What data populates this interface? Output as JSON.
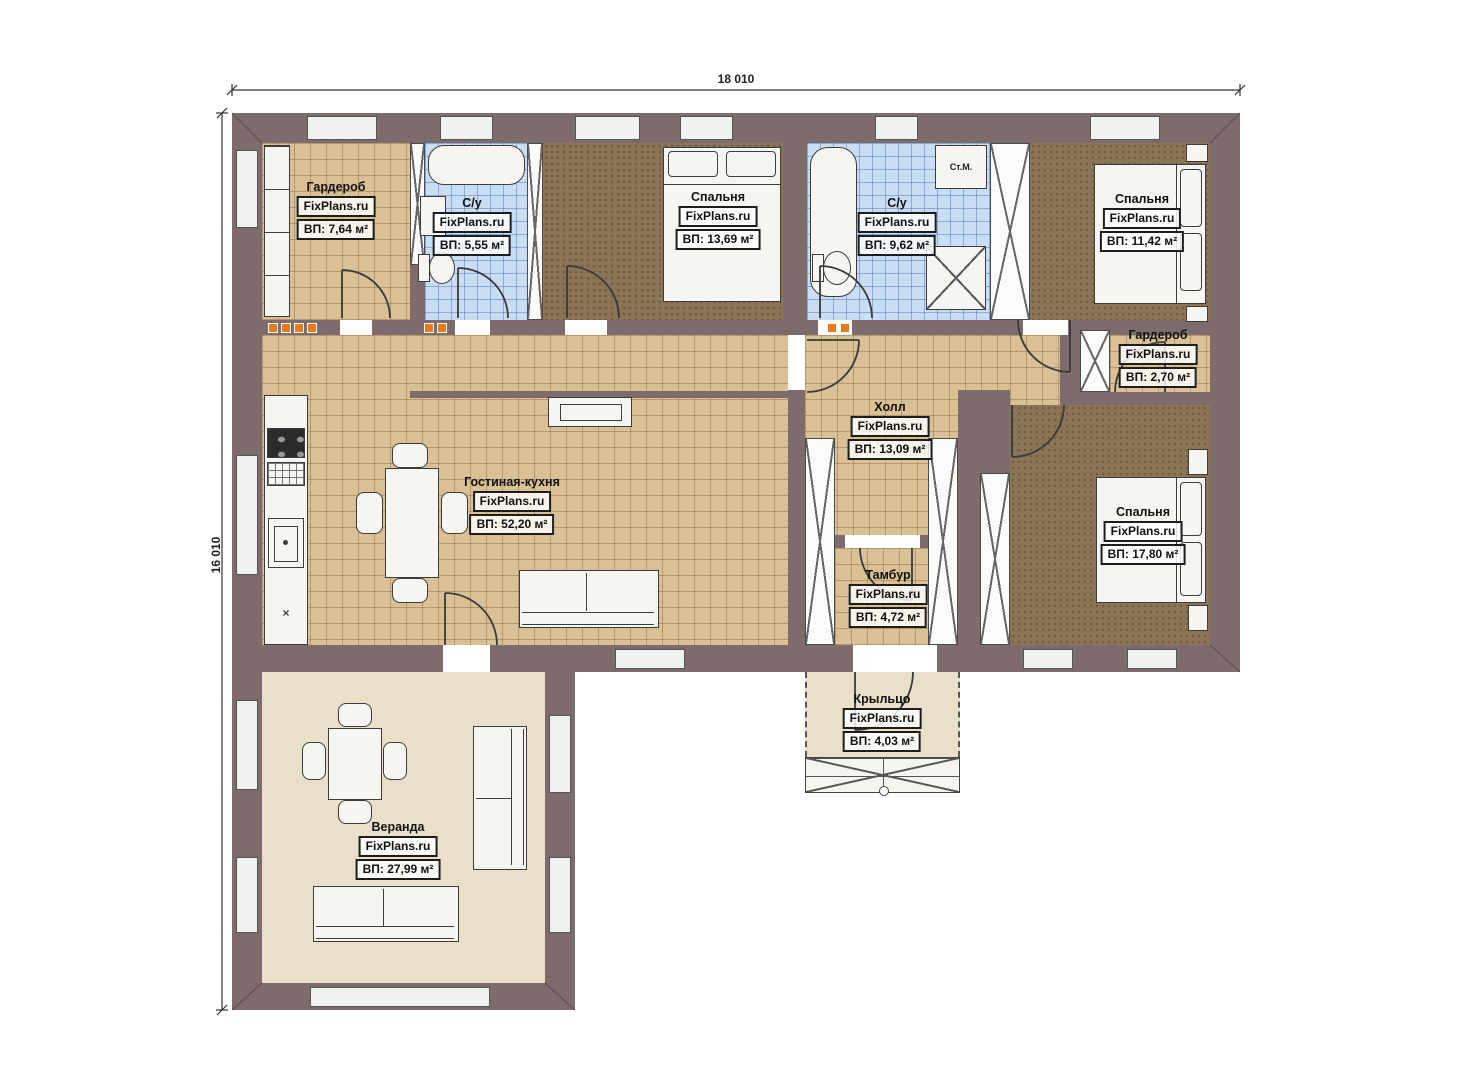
{
  "meta": {
    "watermark": "FixPlans.ru"
  },
  "dimensions": {
    "width_label": "18 010",
    "height_label": "16 010"
  },
  "fixtures": {
    "washing_machine": "Ст.М.",
    "kitchen_mark": "×"
  },
  "colors": {
    "wall": "#7e6b6c",
    "tile_tan": "#d9c095",
    "tile_blue": "#c9ddf4",
    "carpet_brown": "#8c7557",
    "veranda_beige": "#eadfc9",
    "accent_orange": "#e87a1e"
  },
  "rooms": [
    {
      "id": "wardrobe-1",
      "name": "Гардероб",
      "area": "ВП: 7,64 м²"
    },
    {
      "id": "bathroom-1",
      "name": "С/у",
      "area": "ВП: 5,55 м²"
    },
    {
      "id": "bedroom-1",
      "name": "Спальня",
      "area": "ВП: 13,69 м²"
    },
    {
      "id": "bathroom-2",
      "name": "С/у",
      "area": "ВП: 9,62 м²"
    },
    {
      "id": "bedroom-2",
      "name": "Спальня",
      "area": "ВП: 11,42 м²"
    },
    {
      "id": "wardrobe-2",
      "name": "Гардероб",
      "area": "ВП: 2,70 м²"
    },
    {
      "id": "hall",
      "name": "Холл",
      "area": "ВП: 13,09 м²"
    },
    {
      "id": "living",
      "name": "Гостиная-кухня",
      "area": "ВП: 52,20 м²"
    },
    {
      "id": "bedroom-3",
      "name": "Спальня",
      "area": "ВП: 17,80 м²"
    },
    {
      "id": "tambour",
      "name": "Тамбур",
      "area": "ВП: 4,72 м²"
    },
    {
      "id": "porch",
      "name": "Крыльцо",
      "area": "ВП: 4,03 м²"
    },
    {
      "id": "veranda",
      "name": "Веранда",
      "area": "ВП: 27,99 м²"
    }
  ]
}
